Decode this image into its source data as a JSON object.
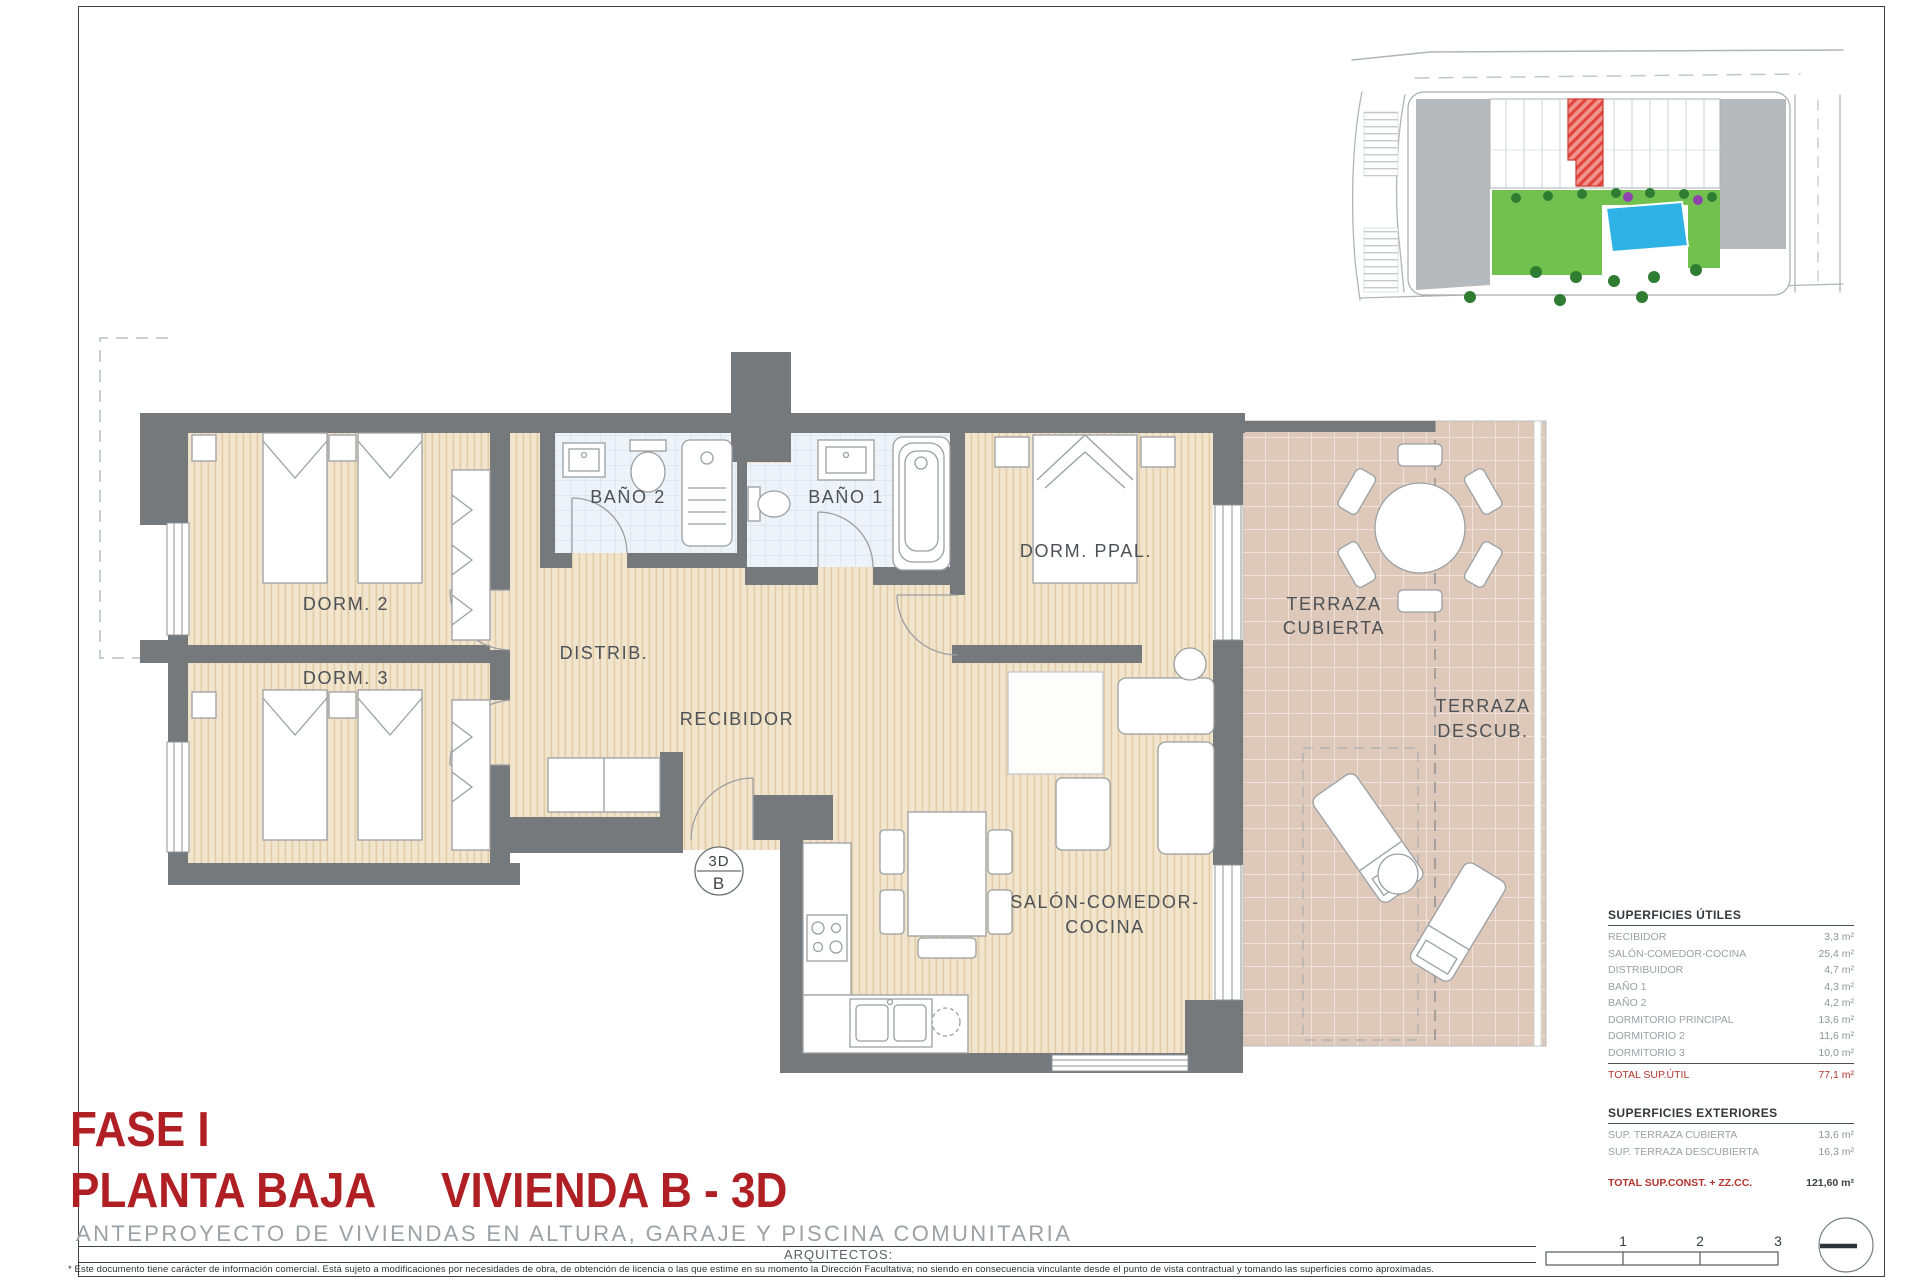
{
  "page": {
    "title_line1": "FASE I",
    "title_line2": "PLANTA BAJA",
    "title_line3": "VIVIENDA B - 3D",
    "subtitle": "ANTEPROYECTO DE VIVIENDAS EN ALTURA, GARAJE Y PISCINA COMUNITARIA",
    "architects_label": "ARQUITECTOS:",
    "disclaimer": "* Este documento tiene carácter de información comercial. Está sujeto a modificaciones por necesidades de obra, de obtención de licencia o las que estime en su momento la Dirección Facultativa; no siendo en consecuencia vinculante desde el punto de vista contractual y tomando las superficies como aproximadas."
  },
  "plan": {
    "rooms": {
      "dorm2": "DORM. 2",
      "dorm3": "DORM. 3",
      "bano2": "BAÑO 2",
      "bano1": "BAÑO 1",
      "distrib": "DISTRIB.",
      "recibidor": "RECIBIDOR",
      "dorm_ppal": "DORM. PPAL.",
      "salon_line1": "SALÓN-COMEDOR-",
      "salon_line2": "COCINA",
      "terraza_cubierta_line1": "TERRAZA",
      "terraza_cubierta_line2": "CUBIERTA",
      "terraza_descub_line1": "TERRAZA",
      "terraza_descub_line2": "DESCUB."
    },
    "marker": {
      "top": "3D",
      "bottom": "B"
    },
    "scale_bar": {
      "tick1": "1",
      "tick2": "2",
      "tick3": "3"
    }
  },
  "tables": {
    "utiles": {
      "title": "SUPERFICIES ÚTILES",
      "rows": [
        {
          "label": "RECIBIDOR",
          "value": "3,3 m²"
        },
        {
          "label": "SALÓN-COMEDOR-COCINA",
          "value": "25,4 m²"
        },
        {
          "label": "DISTRIBUIDOR",
          "value": "4,7 m²"
        },
        {
          "label": "BAÑO 1",
          "value": "4,3 m²"
        },
        {
          "label": "BAÑO 2",
          "value": "4,2 m²"
        },
        {
          "label": "DORMITORIO PRINCIPAL",
          "value": "13,6 m²"
        },
        {
          "label": "DORMITORIO 2",
          "value": "11,6 m²"
        },
        {
          "label": "DORMITORIO 3",
          "value": "10,0 m²"
        }
      ],
      "total_label": "TOTAL SUP.ÚTIL",
      "total_value": "77,1 m²"
    },
    "exteriores": {
      "title": "SUPERFICIES EXTERIORES",
      "rows": [
        {
          "label": "SUP. TERRAZA CUBIERTA",
          "value": "13,6 m²"
        },
        {
          "label": "SUP. TERRAZA DESCUBIERTA",
          "value": "16,3 m²"
        }
      ],
      "total_label": "TOTAL SUP.CONST. + ZZ.CC.",
      "total_value": "121,60 m²"
    }
  },
  "colors": {
    "title_red": "#b01f24",
    "total_red": "#b3342e",
    "wall_gray": "#75797c",
    "wood_floor": "#f2e5cd",
    "bath_floor": "#edf3f8",
    "terrace_floor": "#ddc8ba",
    "highlight_unit_red": "#e2453c",
    "pool_blue": "#2fb2e5",
    "garden_green": "#6cc04a"
  }
}
